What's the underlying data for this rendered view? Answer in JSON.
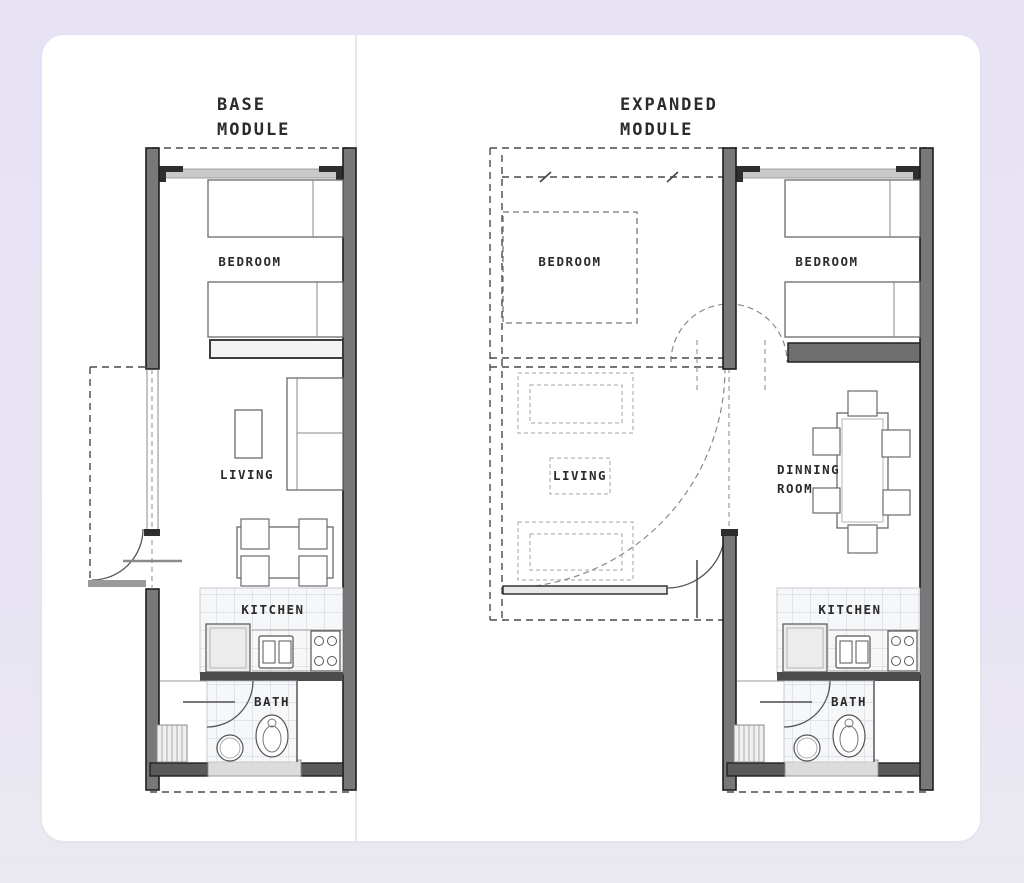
{
  "page": {
    "background_top": "#e7e3f5",
    "background_bottom": "#eae9ef",
    "card_color": "#ffffff"
  },
  "base_module": {
    "title_line1": "BASE",
    "title_line2": "MODULE",
    "labels": {
      "bedroom": "BEDROOM",
      "living": "LIVING",
      "kitchen": "KITCHEN",
      "bath": "BATH"
    }
  },
  "expanded_module": {
    "title_line1": "EXPANDED",
    "title_line2": "MODULE",
    "labels": {
      "bedroom_ghost": "BEDROOM",
      "bedroom": "BEDROOM",
      "living": "LIVING",
      "dining_line1": "DINNING",
      "dining_line2": "ROOM",
      "kitchen": "KITCHEN",
      "bath": "BATH"
    }
  },
  "colors": {
    "wall": "#787878",
    "wall_dark": "#5a5a5a",
    "dashed_line": "#4a4a4a",
    "tile_line": "#ccd3dc",
    "text": "#2b2b2b"
  }
}
